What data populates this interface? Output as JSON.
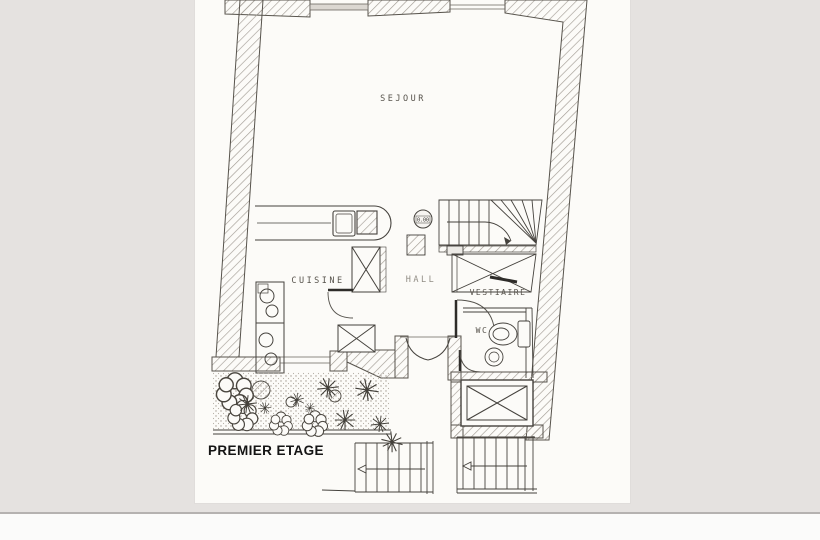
{
  "colors": {
    "canvas_bg": "#e5e2e0",
    "paper": "#fcfbf8",
    "ink": "#45423d",
    "wall_hatch": "#a39d95",
    "terrace_stipple": "#a29b92",
    "title_text": "#141414",
    "footer_band": "#fbfbfa",
    "footer_line": "#b5b2b0"
  },
  "plan": {
    "labels": {
      "sejour": "SEJOUR",
      "cuisine": "CUISINE",
      "hall": "HALL",
      "vestiaire": "VESTIAIRE",
      "wc": "WC"
    },
    "level_marker": "0.00",
    "floor_title": "PREMIER ETAGE"
  }
}
